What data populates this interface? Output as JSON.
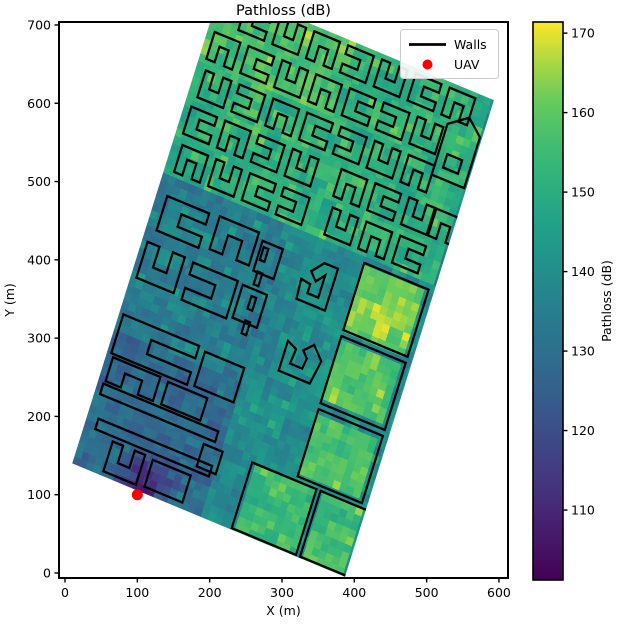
{
  "figure": {
    "width": 622,
    "height": 626,
    "background": "#ffffff"
  },
  "chart_data": {
    "type": "heatmap",
    "title": "Pathloss (dB)",
    "xlabel": "X (m)",
    "ylabel": "Y (m)",
    "x_ticks": [
      0,
      100,
      200,
      300,
      400,
      500,
      600
    ],
    "y_ticks": [
      0,
      100,
      200,
      300,
      400,
      500,
      600,
      700
    ],
    "xlim": [
      -8.3,
      612.5
    ],
    "ylim": [
      -6.4,
      703.8
    ],
    "grid": false,
    "colormap": "viridis",
    "colorbar": {
      "label": "Pathloss (dB)",
      "ticks": [
        110,
        120,
        130,
        140,
        150,
        160,
        170
      ],
      "vmin": 101.2,
      "vmax": 171.4
    },
    "legend": {
      "position": "upper right",
      "entries": [
        {
          "label": "Walls",
          "marker": "line",
          "color": "#000000"
        },
        {
          "label": "UAV",
          "marker": "dot",
          "color": "#ff0000"
        }
      ]
    },
    "uav": {
      "x": 100,
      "y": 100,
      "color": "#ff0000",
      "radius_px": 5.5
    },
    "map": {
      "corner_W": [
        10,
        140
      ],
      "corner_S": [
        387,
        -5
      ],
      "corner_N": [
        216,
        749
      ],
      "size_uv": [
        403,
        639
      ],
      "cell_m": 10,
      "noise_seed": 42,
      "wall_color": "#000000",
      "wall_width": 3,
      "value_regions": [
        {
          "u": [
            0,
            403
          ],
          "v": [
            390,
            640
          ],
          "val": 151
        },
        {
          "u": [
            0,
            200
          ],
          "v": [
            545,
            640
          ],
          "val": 156
        },
        {
          "u": [
            0,
            200
          ],
          "v": [
            0,
            185
          ],
          "val": 128
        },
        {
          "u": [
            0,
            200
          ],
          "v": [
            185,
            390
          ],
          "val": 134
        },
        {
          "u": [
            200,
            300
          ],
          "v": [
            185,
            390
          ],
          "val": 140
        },
        {
          "u": [
            195,
            232
          ],
          "v": [
            0,
            390
          ],
          "val": 138
        },
        {
          "u": [
            237,
            328
          ],
          "v": [
            4,
            88
          ],
          "val": 153
        },
        {
          "u": [
            338,
            403
          ],
          "v": [
            4,
            88
          ],
          "val": 155
        },
        {
          "u": [
            302,
            393
          ],
          "v": [
            98,
            184
          ],
          "val": 157
        },
        {
          "u": [
            302,
            393
          ],
          "v": [
            196,
            282
          ],
          "val": 158
        },
        {
          "u": [
            302,
            393
          ],
          "v": [
            294,
            380
          ],
          "val": 162
        },
        {
          "u": [
            396,
            403
          ],
          "v": [
            0,
            390
          ],
          "val": 137
        }
      ],
      "uav_blob": {
        "u": 100,
        "v": 8,
        "radius": 95,
        "min_val": 107,
        "slope": 0.34,
        "u_max": 205,
        "v_max": 205
      },
      "buildings": [
        {
          "t": "r",
          "u": 235,
          "v": 2,
          "w": 95,
          "h": 88
        },
        {
          "t": "r",
          "u": 336,
          "v": 2,
          "w": 70,
          "h": 88
        },
        {
          "t": "r",
          "u": 300,
          "v": 96,
          "w": 95,
          "h": 90
        },
        {
          "t": "r",
          "u": 300,
          "v": 194,
          "w": 95,
          "h": 90
        },
        {
          "t": "r",
          "u": 300,
          "v": 292,
          "w": 95,
          "h": 90
        },
        {
          "t": "c",
          "u": 6,
          "v": 150,
          "w": 112,
          "h": 52,
          "d": 1
        },
        {
          "t": "r",
          "u": 128,
          "v": 152,
          "w": 58,
          "h": 46
        },
        {
          "t": "r",
          "u": 8,
          "v": 96,
          "w": 170,
          "h": 14
        },
        {
          "t": "r",
          "u": 16,
          "v": 52,
          "w": 168,
          "h": 14
        },
        {
          "t": "c",
          "u": 10,
          "v": 114,
          "w": 70,
          "h": 32,
          "d": 2
        },
        {
          "t": "r",
          "u": 92,
          "v": 114,
          "w": 58,
          "h": 30
        },
        {
          "t": "c",
          "u": 44,
          "v": 6,
          "w": 48,
          "h": 40,
          "d": 0
        },
        {
          "t": "r",
          "u": 104,
          "v": 8,
          "w": 56,
          "h": 36
        },
        {
          "t": "r",
          "u": 164,
          "v": 58,
          "w": 28,
          "h": 30
        },
        {
          "t": "c",
          "u": 15,
          "v": 318,
          "w": 62,
          "h": 46,
          "d": 1
        },
        {
          "t": "c",
          "u": 92,
          "v": 322,
          "w": 58,
          "h": 44,
          "d": 2
        },
        {
          "t": "r",
          "u": 158,
          "v": 318,
          "w": 30,
          "h": 40
        },
        {
          "t": "c",
          "u": 8,
          "v": 252,
          "w": 55,
          "h": 48,
          "d": 0
        },
        {
          "t": "c",
          "u": 76,
          "v": 248,
          "w": 66,
          "h": 50,
          "d": 3
        },
        {
          "t": "r",
          "u": 150,
          "v": 252,
          "w": 36,
          "h": 44
        },
        {
          "t": "r",
          "u": 168,
          "v": 238,
          "w": 7,
          "h": 17
        },
        {
          "t": "r",
          "u": 166,
          "v": 270,
          "w": 7,
          "h": 17
        },
        {
          "t": "r",
          "u": 164,
          "v": 302,
          "w": 7,
          "h": 17
        },
        {
          "t": "r",
          "u": 162,
          "v": 334,
          "w": 7,
          "h": 17
        },
        {
          "t": "p",
          "pts": [
            [
              232,
              212
            ],
            [
              278,
              212
            ],
            [
              284,
              244
            ],
            [
              268,
              260
            ],
            [
              256,
              248
            ],
            [
              264,
              240
            ],
            [
              262,
              226
            ],
            [
              244,
              226
            ],
            [
              246,
              246
            ],
            [
              232,
              252
            ]
          ]
        },
        {
          "t": "p",
          "pts": [
            [
              226,
              306
            ],
            [
              268,
              306
            ],
            [
              268,
              362
            ],
            [
              248,
              362
            ],
            [
              234,
              346
            ],
            [
              244,
              336
            ],
            [
              254,
              348
            ],
            [
              254,
              318
            ],
            [
              238,
              318
            ],
            [
              238,
              330
            ],
            [
              224,
              332
            ]
          ]
        },
        {
          "t": "p",
          "pts": [
            [
              352,
              520
            ],
            [
              400,
              520
            ],
            [
              400,
              588
            ],
            [
              378,
              606
            ],
            [
              352,
              588
            ]
          ]
        },
        {
          "t": "r",
          "u": 364,
          "v": 534,
          "w": 22,
          "h": 18
        }
      ],
      "maze_rows": [
        {
          "v": 396,
          "h": 36,
          "w": 38,
          "slots": [
            14,
            64,
            114,
            164,
            236,
            286,
            336
          ],
          "dirs": [
            2,
            0,
            1,
            3,
            0,
            2,
            1
          ]
        },
        {
          "v": 446,
          "h": 36,
          "w": 38,
          "slots": [
            10,
            60,
            110,
            160,
            232,
            282,
            332,
            372
          ],
          "dirs": [
            1,
            2,
            3,
            0,
            2,
            1,
            0,
            2
          ]
        },
        {
          "v": 496,
          "h": 36,
          "w": 38,
          "slots": [
            14,
            64,
            114,
            164,
            214,
            264,
            314
          ],
          "dirs": [
            0,
            3,
            2,
            1,
            3,
            0,
            2
          ]
        },
        {
          "v": 546,
          "h": 36,
          "w": 38,
          "slots": [
            10,
            60,
            110,
            160,
            210,
            260,
            310
          ],
          "dirs": [
            2,
            1,
            0,
            2,
            1,
            3,
            0
          ]
        },
        {
          "v": 596,
          "h": 36,
          "w": 38,
          "slots": [
            40,
            90,
            140,
            190,
            240,
            290,
            340
          ],
          "dirs": [
            1,
            0,
            2,
            3,
            0,
            1,
            2
          ]
        }
      ]
    },
    "viridis_stops": [
      [
        68,
        1,
        84
      ],
      [
        72,
        40,
        120
      ],
      [
        62,
        74,
        137
      ],
      [
        49,
        104,
        142
      ],
      [
        38,
        130,
        142
      ],
      [
        31,
        158,
        137
      ],
      [
        53,
        183,
        121
      ],
      [
        109,
        205,
        89
      ],
      [
        253,
        231,
        37
      ]
    ]
  }
}
